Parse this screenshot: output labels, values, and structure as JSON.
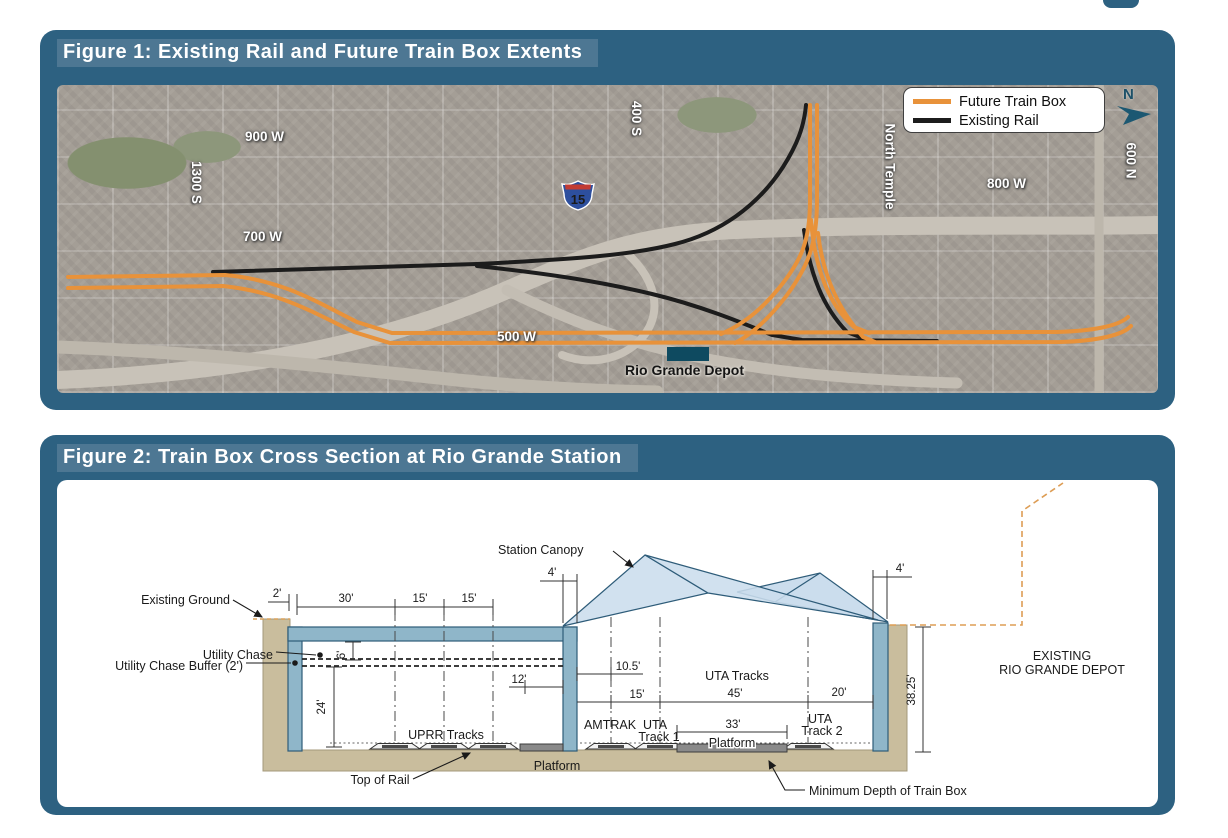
{
  "figure1": {
    "title": "Figure 1: Existing Rail and Future Train Box Extents",
    "legend": {
      "future_label": "Future Train Box",
      "existing_label": "Existing Rail"
    },
    "compass_n": "N",
    "interstate_shield": "15",
    "map_labels": {
      "w900": "900 W",
      "s1300": "1300 S",
      "w700": "700 W",
      "s400": "400 S",
      "north_temple": "North Temple",
      "w800": "800 W",
      "n600": "600 N",
      "w500": "500 W",
      "depot": "Rio Grande Depot"
    },
    "colors": {
      "future_train_box": "#E8923A",
      "existing_rail": "#1C1C1C",
      "panel_teal": "#2D6181"
    }
  },
  "figure2": {
    "title": "Figure 2: Train Box Cross Section at Rio Grande Station",
    "labels": {
      "station_canopy": "Station Canopy",
      "existing_ground": "Existing Ground",
      "utility_chase": "Utility Chase",
      "utility_chase_buffer": "Utility Chase Buffer (2')",
      "uprr_tracks": "UPRR Tracks",
      "top_of_rail": "Top of Rail",
      "platform_left": "Platform",
      "platform_center": "Platform",
      "amtrak": "AMTRAK",
      "uta1_line1": "UTA",
      "uta1_line2": "Track 1",
      "uta2_line1": "UTA",
      "uta2_line2": "Track 2",
      "uta_tracks": "UTA Tracks",
      "min_depth": "Minimum Depth of Train Box",
      "existing_depot_line1": "EXISTING",
      "existing_depot_line2": "RIO GRANDE DEPOT"
    },
    "dimensions": {
      "d2": "2'",
      "d30": "30'",
      "d15a": "15'",
      "d15b": "15'",
      "d4_left": "4'",
      "d4_right": "4'",
      "d6": "6'",
      "d24": "24'",
      "d12": "12'",
      "d10_5": "10.5'",
      "d15c": "15'",
      "d45": "45'",
      "d20": "20'",
      "d33": "33'",
      "d38_25": "38.25'"
    },
    "colors": {
      "wall_blue": "#8FB6C9",
      "ground_tan": "#C9BD9D",
      "canopy_blue": "#CBDDED",
      "depot_outline_dash": "#DD9D55"
    }
  }
}
